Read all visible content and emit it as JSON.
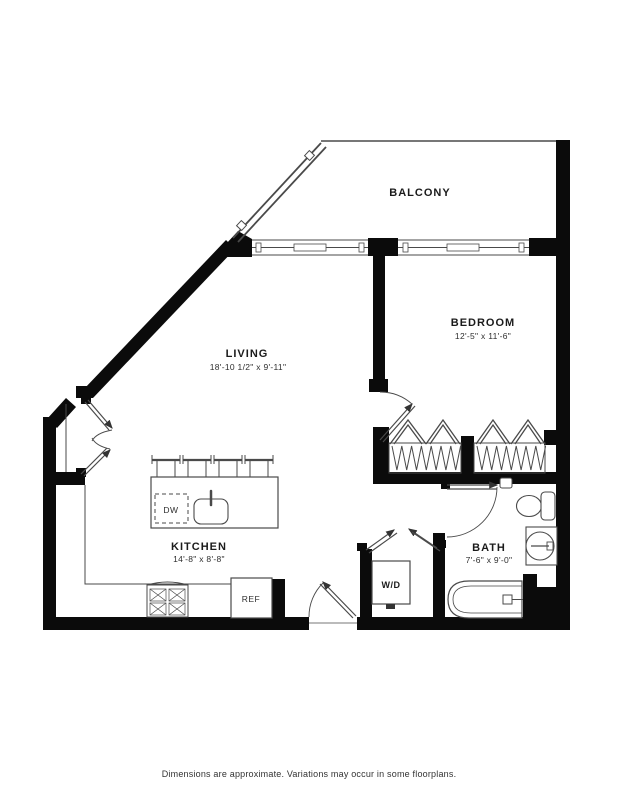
{
  "document": {
    "background": "#ffffff",
    "footer_note": "Dimensions are approximate. Variations may occur in some floorplans."
  },
  "floorplan": {
    "rooms": {
      "balcony": {
        "name": "BALCONY"
      },
      "bedroom": {
        "name": "BEDROOM",
        "dims": "12'-5\" x 11'-6\""
      },
      "living": {
        "name": "LIVING",
        "dims": "18'-10 1/2\" x 9'-11\""
      },
      "kitchen": {
        "name": "KITCHEN",
        "dims": "14'-8\" x 8'-8\""
      },
      "bath": {
        "name": "BATH",
        "dims": "7'-6\" x 9'-0\""
      }
    },
    "appliances": {
      "washer_dryer": "W/D",
      "dishwasher": "DW",
      "refrigerator": "REF"
    },
    "colors": {
      "wall": "#0b0b0b",
      "line": "#4a4a4a",
      "label": "#1b1b1b"
    }
  }
}
